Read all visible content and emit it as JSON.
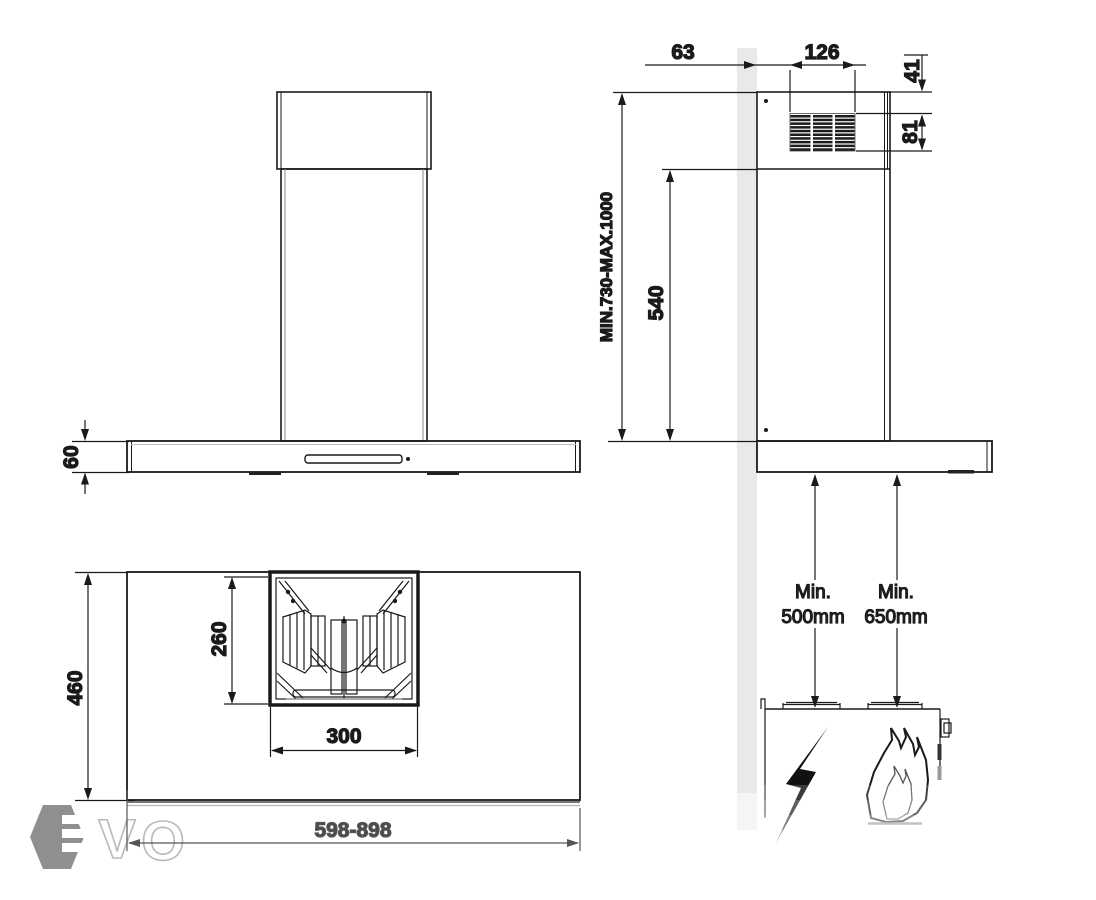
{
  "drawing": {
    "type": "installation-dimension-diagram",
    "subject": "wall-mounted chimney cooker hood with telescopic flue, hob clearance diagram",
    "units": "mm",
    "views": [
      "front-view",
      "side-view-on-wall-with-hob",
      "bottom-plan-view"
    ]
  },
  "dims": {
    "d63": "63",
    "d126": "126",
    "d41": "41",
    "d81": "81",
    "mount_height": "MIN.730-MAX.1000",
    "d540": "540",
    "d60": "60",
    "d460": "460",
    "d260": "260",
    "d300": "300",
    "width_range": "598-898"
  },
  "clearances": {
    "electric": {
      "line1": "Min.",
      "line2": "500mm"
    },
    "gas": {
      "line1": "Min.",
      "line2": "650mm"
    }
  },
  "icons": {
    "electric_hob": "lightning-bolt-icon",
    "gas_hob": "flame-icon"
  },
  "logo": {
    "brand": "EVO",
    "letter_v": "V",
    "letter_o": "O"
  },
  "colors": {
    "line": "#1a1a1a",
    "wall_fill": "#e9e9e9",
    "gray_dim": "#4a4a4a",
    "logo_gray": "#8f8f8f",
    "logo_outline": "#b9b9b9"
  }
}
